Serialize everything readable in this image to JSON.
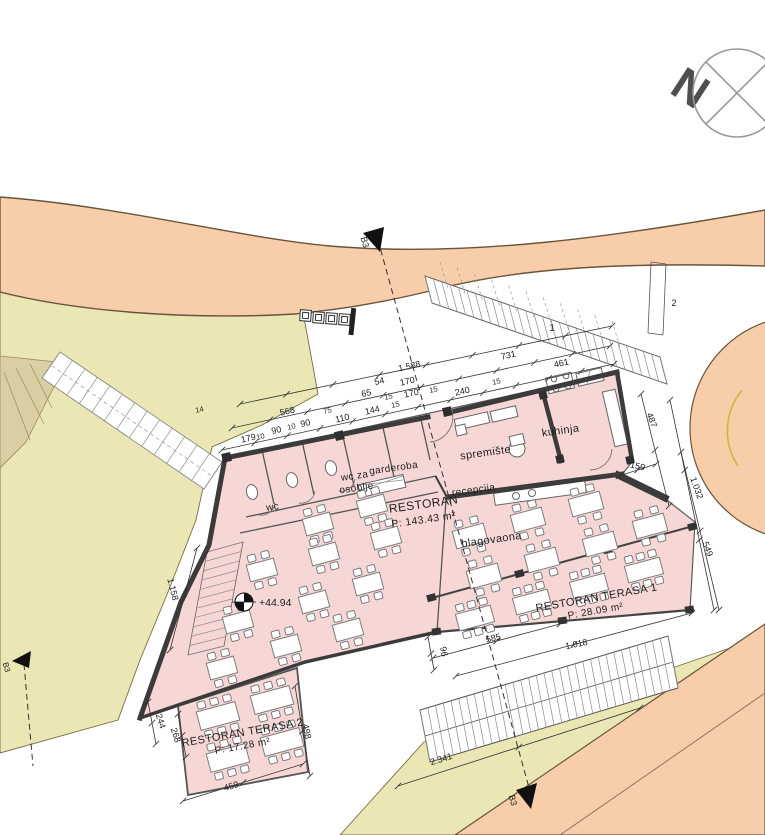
{
  "compass": {
    "north_label": "N"
  },
  "markers": {
    "elevation": "+44.94",
    "stair_area_1": "1",
    "stair_area_2": "2",
    "section_top": "B3",
    "section_bottom": "B3",
    "section_left": "B3"
  },
  "rooms": {
    "restoran": {
      "name": "RESTORAN",
      "area": "P: 143.43 m²"
    },
    "kuhinja": {
      "name": "kuhinja"
    },
    "spremiste": {
      "name": "spremište"
    },
    "recepcija": {
      "name": "recepcija"
    },
    "garderoba": {
      "name": "garderoba"
    },
    "wc_osoblje_line1": {
      "name": "wc za"
    },
    "wc_osoblje_line2": {
      "name": "osoblje"
    },
    "wc": {
      "name": "wc"
    },
    "blagovaona": {
      "name": "blagovaona"
    },
    "terasa1": {
      "name": "RESTORAN TERASA 1",
      "area": "P: 28.09 m²"
    },
    "terasa2": {
      "name": "RESTORAN TERASA 2",
      "area": "P: 17.28 m²"
    }
  },
  "dimensions": [
    {
      "t": "1.588",
      "x": 410,
      "y": 369,
      "r": -13
    },
    {
      "t": "54",
      "x": 380,
      "y": 384,
      "r": -13
    },
    {
      "t": "170",
      "x": 408,
      "y": 384,
      "r": -13
    },
    {
      "t": "65",
      "x": 367,
      "y": 396,
      "r": -13
    },
    {
      "t": "15",
      "x": 389,
      "y": 399,
      "r": -13,
      "s": 7.5
    },
    {
      "t": "170",
      "x": 412,
      "y": 396,
      "r": -13
    },
    {
      "t": "15",
      "x": 434,
      "y": 392,
      "r": -13,
      "s": 7.5
    },
    {
      "t": "240",
      "x": 463,
      "y": 394,
      "r": -13
    },
    {
      "t": "15",
      "x": 497,
      "y": 384,
      "r": -13,
      "s": 7.5
    },
    {
      "t": "731",
      "x": 509,
      "y": 358,
      "r": -13
    },
    {
      "t": "461",
      "x": 562,
      "y": 366,
      "r": -13
    },
    {
      "t": "14",
      "x": 200,
      "y": 412,
      "r": -13,
      "s": 7.5
    },
    {
      "t": "568",
      "x": 288,
      "y": 414,
      "r": -13
    },
    {
      "t": "179",
      "x": 249,
      "y": 441,
      "r": -13
    },
    {
      "t": "10",
      "x": 261,
      "y": 439,
      "r": -13,
      "s": 7.5
    },
    {
      "t": "90",
      "x": 277,
      "y": 433,
      "r": -13
    },
    {
      "t": "10",
      "x": 292,
      "y": 429,
      "r": -13,
      "s": 7.5
    },
    {
      "t": "90",
      "x": 306,
      "y": 426,
      "r": -13
    },
    {
      "t": "75",
      "x": 328,
      "y": 413,
      "r": -13,
      "s": 7.5
    },
    {
      "t": "110",
      "x": 343,
      "y": 421,
      "r": -13
    },
    {
      "t": "144",
      "x": 373,
      "y": 413,
      "r": -13
    },
    {
      "t": "15",
      "x": 396,
      "y": 407,
      "r": -13,
      "s": 7.5
    },
    {
      "t": "1.158",
      "x": 170,
      "y": 590,
      "r": 76
    },
    {
      "t": "487",
      "x": 649,
      "y": 421,
      "r": 70
    },
    {
      "t": "159",
      "x": 637,
      "y": 469,
      "r": 12
    },
    {
      "t": "1.032",
      "x": 694,
      "y": 489,
      "r": 70
    },
    {
      "t": "549",
      "x": 705,
      "y": 550,
      "r": 70
    },
    {
      "t": "96",
      "x": 441,
      "y": 652,
      "r": 80
    },
    {
      "t": "585",
      "x": 494,
      "y": 641,
      "r": -13
    },
    {
      "t": "1.018",
      "x": 577,
      "y": 647,
      "r": -12
    },
    {
      "t": "2.341",
      "x": 442,
      "y": 762,
      "r": -17
    },
    {
      "t": "459",
      "x": 232,
      "y": 789,
      "r": -16
    },
    {
      "t": "268",
      "x": 173,
      "y": 736,
      "r": 72
    },
    {
      "t": "244",
      "x": 158,
      "y": 722,
      "r": 72
    },
    {
      "t": "498",
      "x": 304,
      "y": 732,
      "r": 78
    }
  ],
  "tables": [
    {
      "x": 372,
      "y": 506,
      "w": 28,
      "h": 17,
      "c": 2
    },
    {
      "x": 318,
      "y": 524,
      "w": 28,
      "h": 17,
      "c": 2
    },
    {
      "x": 262,
      "y": 570,
      "w": 28,
      "h": 17,
      "c": 2
    },
    {
      "x": 324,
      "y": 554,
      "w": 28,
      "h": 17,
      "c": 2
    },
    {
      "x": 386,
      "y": 538,
      "w": 28,
      "h": 17,
      "c": 2
    },
    {
      "x": 238,
      "y": 622,
      "w": 28,
      "h": 17,
      "c": 2
    },
    {
      "x": 314,
      "y": 602,
      "w": 28,
      "h": 17,
      "c": 2
    },
    {
      "x": 368,
      "y": 584,
      "w": 28,
      "h": 17,
      "c": 2
    },
    {
      "x": 286,
      "y": 646,
      "w": 28,
      "h": 17,
      "c": 2
    },
    {
      "x": 348,
      "y": 630,
      "w": 28,
      "h": 17,
      "c": 2
    },
    {
      "x": 222,
      "y": 668,
      "w": 28,
      "h": 17,
      "c": 2
    },
    {
      "x": 470,
      "y": 536,
      "w": 32,
      "h": 18,
      "c": 2
    },
    {
      "x": 528,
      "y": 520,
      "w": 32,
      "h": 18,
      "c": 2
    },
    {
      "x": 586,
      "y": 504,
      "w": 32,
      "h": 18,
      "c": 2
    },
    {
      "x": 484,
      "y": 576,
      "w": 32,
      "h": 18,
      "c": 2
    },
    {
      "x": 542,
      "y": 560,
      "w": 32,
      "h": 18,
      "c": 2
    },
    {
      "x": 600,
      "y": 544,
      "w": 32,
      "h": 18,
      "c": 2
    },
    {
      "x": 650,
      "y": 526,
      "w": 32,
      "h": 18,
      "c": 2
    },
    {
      "x": 475,
      "y": 618,
      "w": 36,
      "h": 17,
      "c": 3
    },
    {
      "x": 532,
      "y": 602,
      "w": 36,
      "h": 17,
      "c": 3
    },
    {
      "x": 589,
      "y": 586,
      "w": 36,
      "h": 17,
      "c": 3
    },
    {
      "x": 644,
      "y": 570,
      "w": 36,
      "h": 17,
      "c": 3
    },
    {
      "x": 218,
      "y": 716,
      "w": 40,
      "h": 19,
      "c": 3
    },
    {
      "x": 272,
      "y": 700,
      "w": 40,
      "h": 19,
      "c": 3
    },
    {
      "x": 228,
      "y": 758,
      "w": 40,
      "h": 19,
      "c": 3
    },
    {
      "x": 282,
      "y": 742,
      "w": 40,
      "h": 19,
      "c": 3
    }
  ],
  "colors": {
    "road": "#f8cdaa",
    "road_edge": "#68553a",
    "terrain": "#eae7b4",
    "terrain_dark": "#d9cfa2",
    "building": "#f7d7d5",
    "wall": "#3b3b3b",
    "yellow_curb": "#cdb83d"
  }
}
